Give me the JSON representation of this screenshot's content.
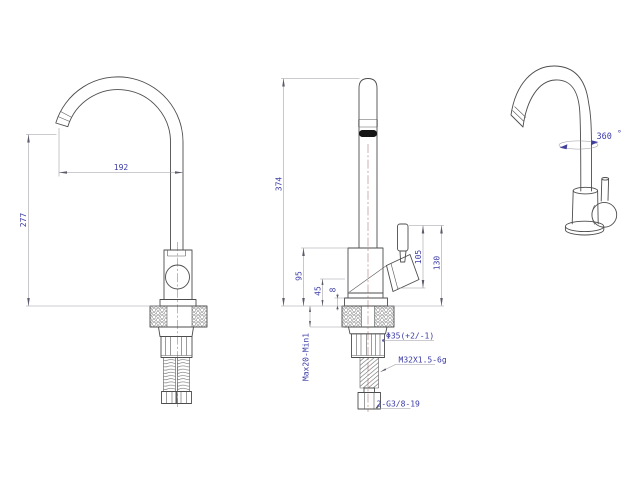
{
  "drawing": {
    "background": "#ffffff",
    "line_color": "#4d4d4d",
    "dim_line_color": "#9a9aa2",
    "dim_text_color": "#3b3ba6",
    "centerline_color": "#9d6262"
  },
  "front_view": {
    "height_dim": "277",
    "reach_dim": "192"
  },
  "side_view": {
    "overall_height_dim": "374",
    "body_height_dim": "95",
    "spout_offset_dim": "45",
    "flange_thickness_dim": "8",
    "handle_base_height_dim": "105",
    "handle_top_height_dim": "130",
    "mounting_range_label": "Max20-Min1",
    "hole_diameter_label": "Φ35(+2/-1)",
    "thread_spec_label": "M32X1.5-6g",
    "hose_thread_label": "2-G3/8-19"
  },
  "perspective_view": {
    "rotation_value": "360",
    "degree_symbol": "°"
  }
}
